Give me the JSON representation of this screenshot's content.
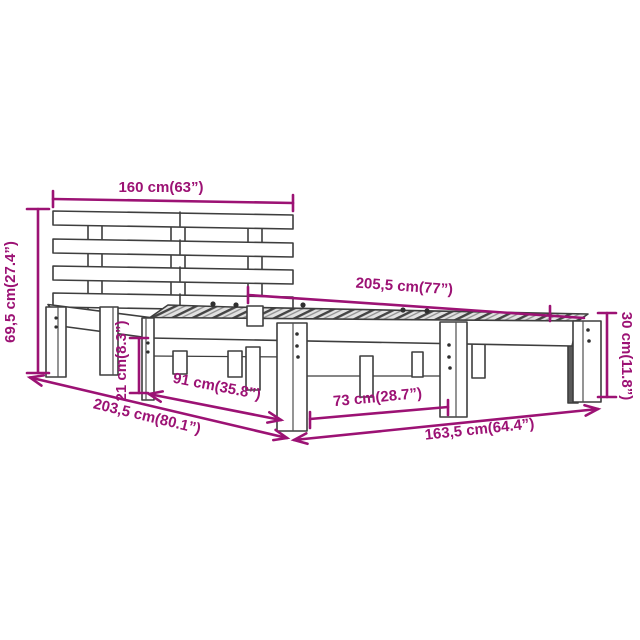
{
  "diagram": {
    "subject_label": "bed frame dimension diagram",
    "colors": {
      "dimension": "#9C1274",
      "line_art": "#3E3E3E"
    },
    "dimensions": {
      "headboard_width": "160 cm(63”)",
      "headboard_height": "69,5 cm(27.4”)",
      "total_length": "205,5 cm(77”)",
      "side_height": "30 cm(11.8”)",
      "under_clearance": "21 cm(8.3”)",
      "leg_spacing_head": "91 cm(35.8”)",
      "leg_spacing_foot": "73 cm(28.7”)",
      "floor_length": "203,5 cm(80.1”)",
      "frame_length": "163,5 cm(64.4”)"
    }
  }
}
